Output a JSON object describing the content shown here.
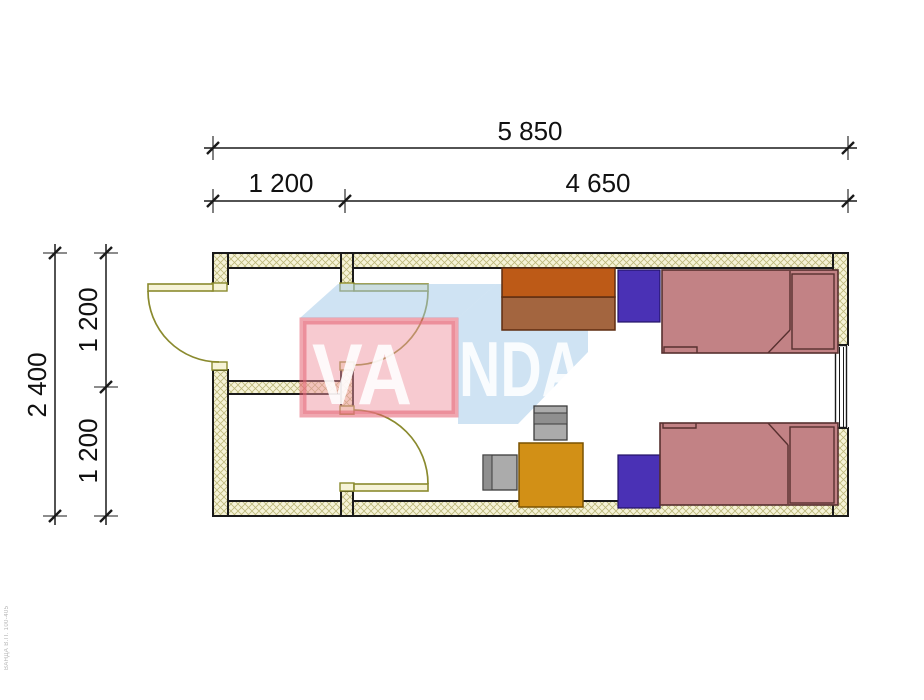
{
  "drawing": {
    "type": "floor-plan",
    "background": "#ffffff"
  },
  "dimensions": {
    "top_total": "5 850",
    "top_left": "1 200",
    "top_right": "4 650",
    "side_total": "2 400",
    "side_upper": "1 200",
    "side_lower": "1 200"
  },
  "watermark": {
    "brand": "VANDA",
    "text_front": "VA",
    "text_back": "NDA",
    "front_fill": "rgba(240,150,162,0.50)",
    "front_edge": "rgba(228,95,112,0.55)",
    "blue_fill": "rgba(160,200,232,0.50)",
    "letter_fill": "rgba(255,255,255,0.88)"
  },
  "plan_colors": {
    "wall_fill": "#f6f3d7",
    "hatch_line": "#bdb87b",
    "wall_stroke": "#1a1a1a",
    "door": "#8a8a2e",
    "dimension": "#111111"
  },
  "furniture_colors": {
    "wardrobe_top": "#bd5a17",
    "wardrobe_bottom": "#a3653f",
    "wardrobe_stroke": "#5f2d10",
    "cabinet": "#4a31b5",
    "cabinet_stroke": "#221366",
    "bed": "#c28285",
    "bed_stroke": "#57302f",
    "table": "#d29016",
    "table_stroke": "#7a5200",
    "chair": "#ababab",
    "chair_back": "#8f8f8f",
    "chair_stroke": "#3c3c3c"
  },
  "footer_note": "ВАНДА  В.П. 100-405"
}
